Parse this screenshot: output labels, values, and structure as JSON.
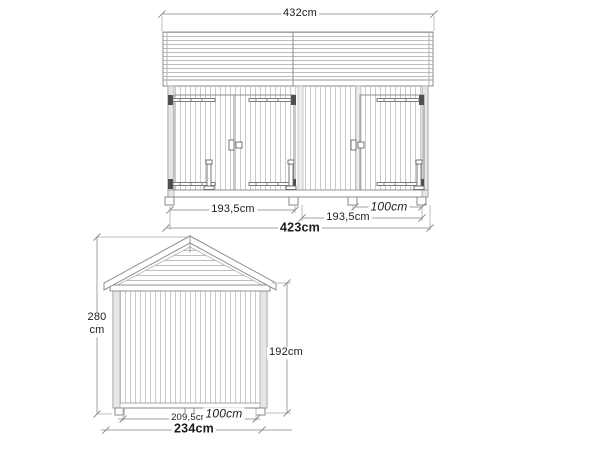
{
  "drawing_type": "garden-shed-technical-drawing",
  "front_elevation": {
    "labels": {
      "roof_width": "432cm",
      "left_module": "193,5cm",
      "right_module": "193,5cm",
      "shelter": "100cm",
      "total_width": "423cm"
    }
  },
  "side_elevation": {
    "labels": {
      "ridge_height_value": "280",
      "ridge_height_unit": "cm",
      "wall_height": "192cm",
      "module_depth": "209,5cm",
      "shelter_depth": "100cm",
      "total_depth": "234cm"
    }
  },
  "style": {
    "background": "#ffffff",
    "outline": "#8f8f8f",
    "board_line": "#c9c9c9",
    "roof_board_line": "#bdbdbd",
    "dim_line": "#a3a3a3",
    "hardware": "#5a5a5a",
    "text": "#1c1c1c"
  }
}
